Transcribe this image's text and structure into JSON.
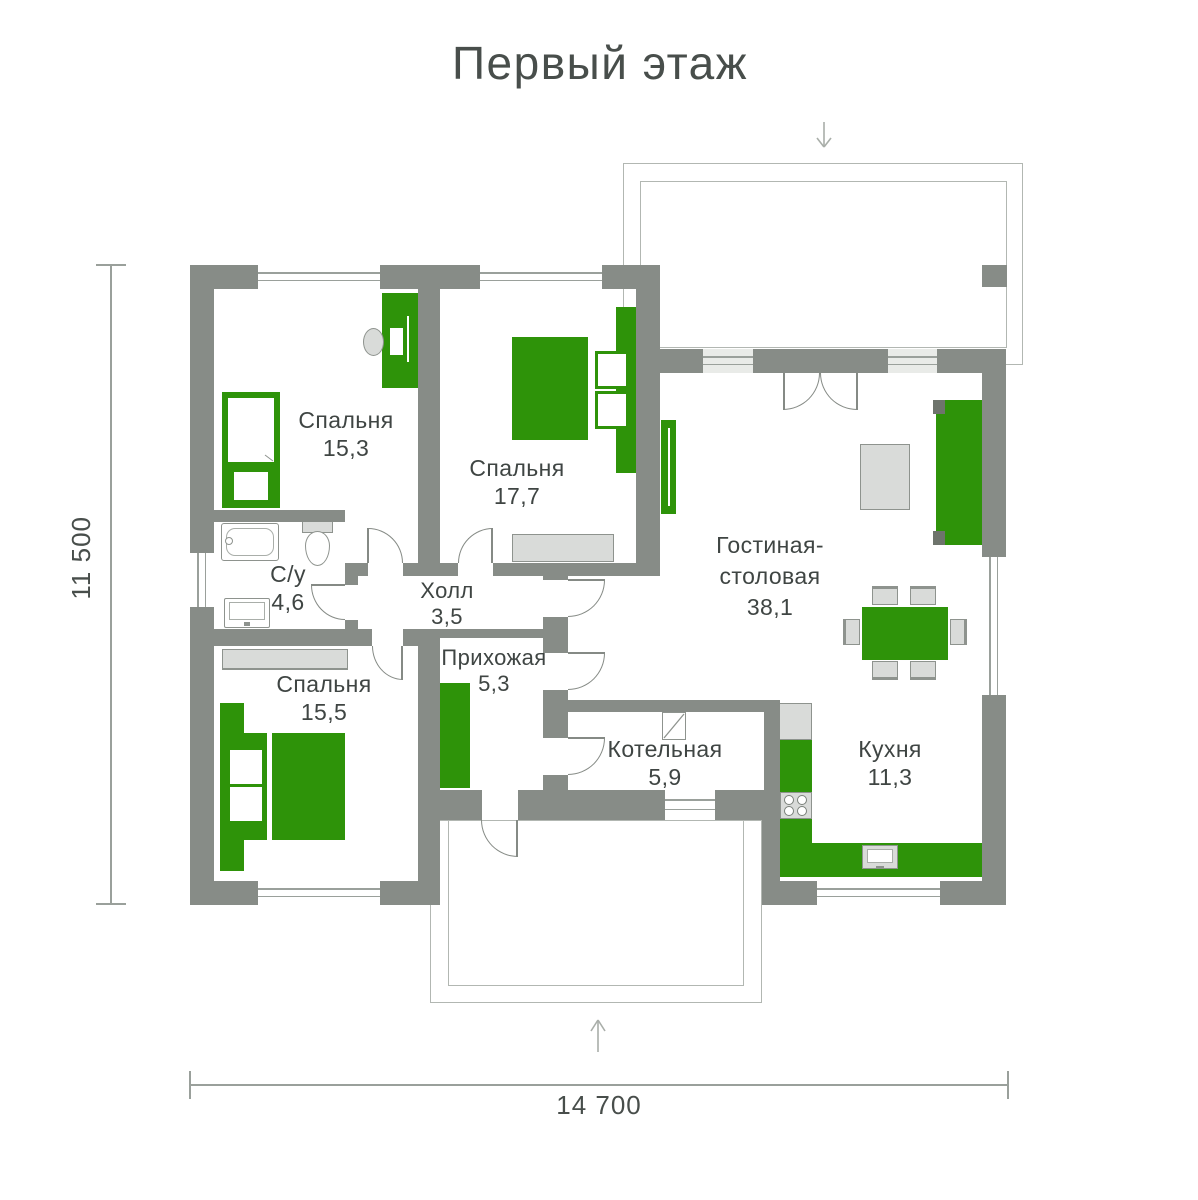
{
  "title": "Первый этаж",
  "dimensions": {
    "height": "11 500",
    "width": "14 700"
  },
  "rooms": [
    {
      "key": "bedroom-1",
      "name": "Спальня",
      "area": "15,3"
    },
    {
      "key": "bedroom-2",
      "name": "Спальня",
      "area": "17,7"
    },
    {
      "key": "bathroom",
      "name": "С/у",
      "area": "4,6"
    },
    {
      "key": "hall",
      "name": "Холл",
      "area": "3,5"
    },
    {
      "key": "bedroom-3",
      "name": "Спальня",
      "area": "15,5"
    },
    {
      "key": "entry",
      "name": "Прихожая",
      "area": "5,3"
    },
    {
      "key": "boiler-room",
      "name": "Котельная",
      "area": "5,9"
    },
    {
      "key": "living-dining",
      "name": "Гостиная-столовая",
      "area": "38,1"
    },
    {
      "key": "kitchen",
      "name": "Кухня",
      "area": "11,3"
    }
  ],
  "colors": {
    "wall": "#878C87",
    "furniture_accent": "#2E9309",
    "furniture_light": "#D9DBD9",
    "outline": "#9AA09B",
    "text": "#3F4543"
  }
}
